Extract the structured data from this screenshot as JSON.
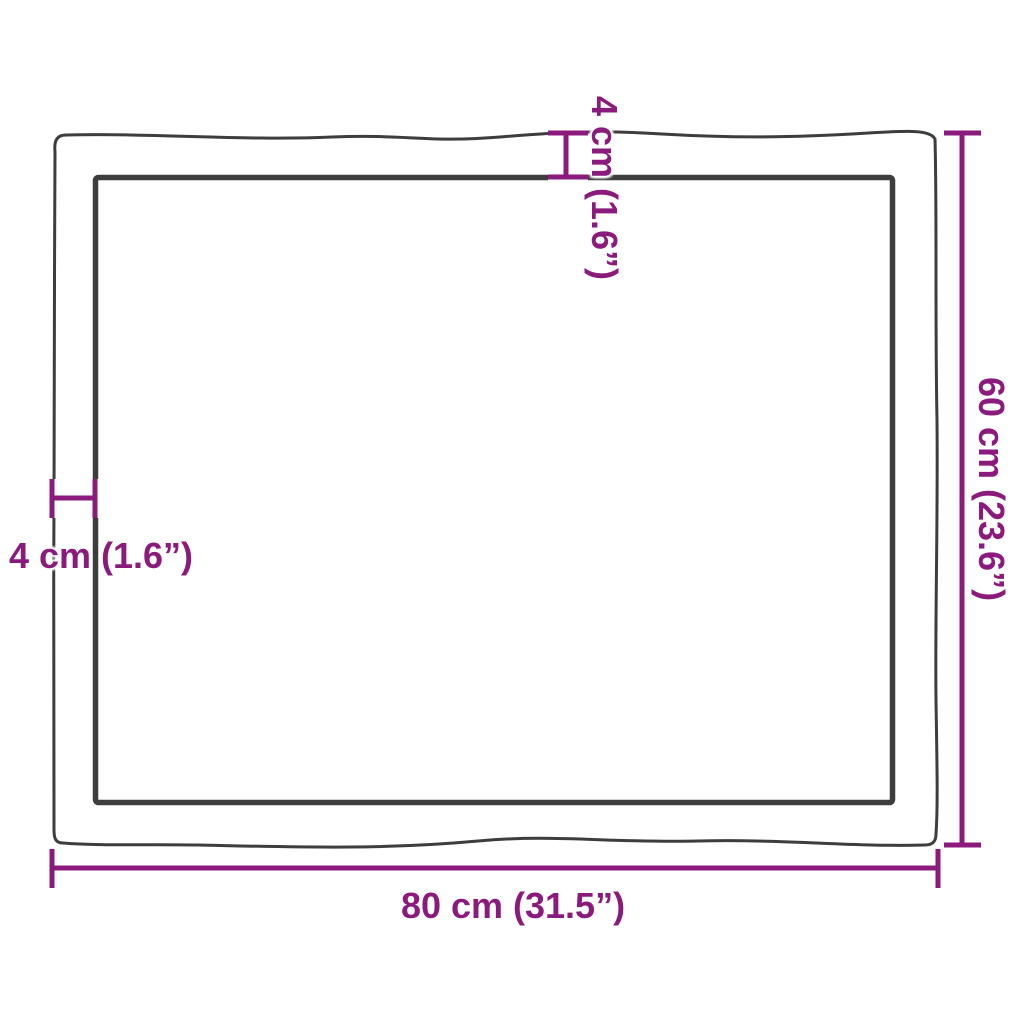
{
  "diagram": {
    "kind": "product-dimension-diagram",
    "labels": {
      "width_bottom": "80 cm (31.5”)",
      "height_right": "60 cm (23.6”)",
      "thickness_top": "4 cm (1.6”)",
      "thickness_left": "4 cm (1.6”)"
    },
    "dimensions": {
      "width_cm": 80,
      "width_in": 31.5,
      "height_cm": 60,
      "height_in": 23.6,
      "thickness_cm": 4,
      "thickness_in": 1.6
    },
    "colors": {
      "dimension_accent": "#8b1a7d",
      "outline": "#3d3d3d",
      "background": "#ffffff"
    }
  }
}
